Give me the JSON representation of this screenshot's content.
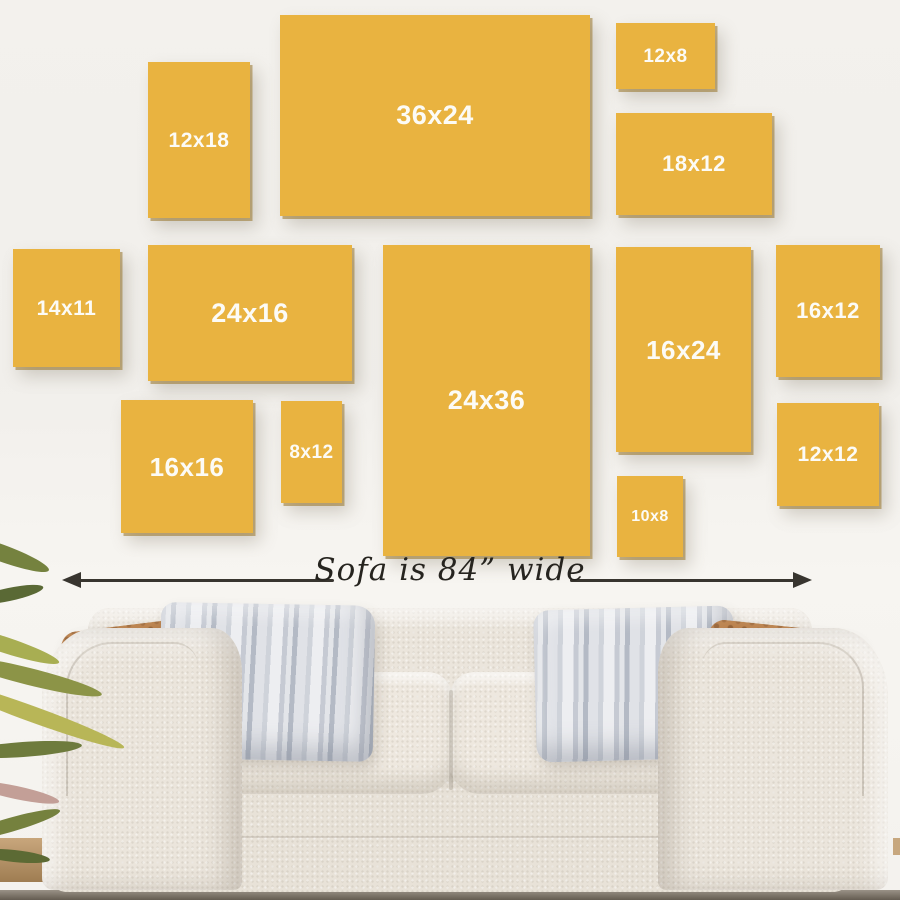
{
  "title": "Wall art size guide above a sofa",
  "colors": {
    "wall": "#f1efeb",
    "frame": "#e9b340",
    "frame_label": "#fcfbf6",
    "arrow": "#38352f",
    "measure_text": "#26241f",
    "sofa_body": "#ebe5dc",
    "sofa_cushion": "#eee8df",
    "pillow_brown": "#b1743c",
    "pillow_gray": "#c6cad3",
    "leaf_green": "#8c9447",
    "floor": "#645c51"
  },
  "frames": [
    {
      "label": "12x18",
      "x": 148,
      "y": 62,
      "w": 102,
      "h": 156,
      "label_px": 21
    },
    {
      "label": "36x24",
      "x": 280,
      "y": 15,
      "w": 310,
      "h": 201,
      "label_px": 27
    },
    {
      "label": "12x8",
      "x": 616,
      "y": 23,
      "w": 99,
      "h": 66,
      "label_px": 19
    },
    {
      "label": "18x12",
      "x": 616,
      "y": 113,
      "w": 156,
      "h": 102,
      "label_px": 22
    },
    {
      "label": "14x11",
      "x": 13,
      "y": 249,
      "w": 107,
      "h": 118,
      "label_px": 21
    },
    {
      "label": "24x16",
      "x": 148,
      "y": 245,
      "w": 204,
      "h": 136,
      "label_px": 27
    },
    {
      "label": "24x36",
      "x": 383,
      "y": 245,
      "w": 207,
      "h": 311,
      "label_px": 27
    },
    {
      "label": "16x24",
      "x": 616,
      "y": 247,
      "w": 135,
      "h": 205,
      "label_px": 26
    },
    {
      "label": "16x12",
      "x": 776,
      "y": 245,
      "w": 104,
      "h": 132,
      "label_px": 22
    },
    {
      "label": "16x16",
      "x": 121,
      "y": 400,
      "w": 132,
      "h": 133,
      "label_px": 26
    },
    {
      "label": "8x12",
      "x": 281,
      "y": 401,
      "w": 61,
      "h": 102,
      "label_px": 19
    },
    {
      "label": "10x8",
      "x": 617,
      "y": 476,
      "w": 66,
      "h": 81,
      "label_px": 16
    },
    {
      "label": "12x12",
      "x": 777,
      "y": 403,
      "w": 102,
      "h": 103,
      "label_px": 21
    }
  ],
  "measurement": {
    "label": "Sofa is 84” wide"
  }
}
